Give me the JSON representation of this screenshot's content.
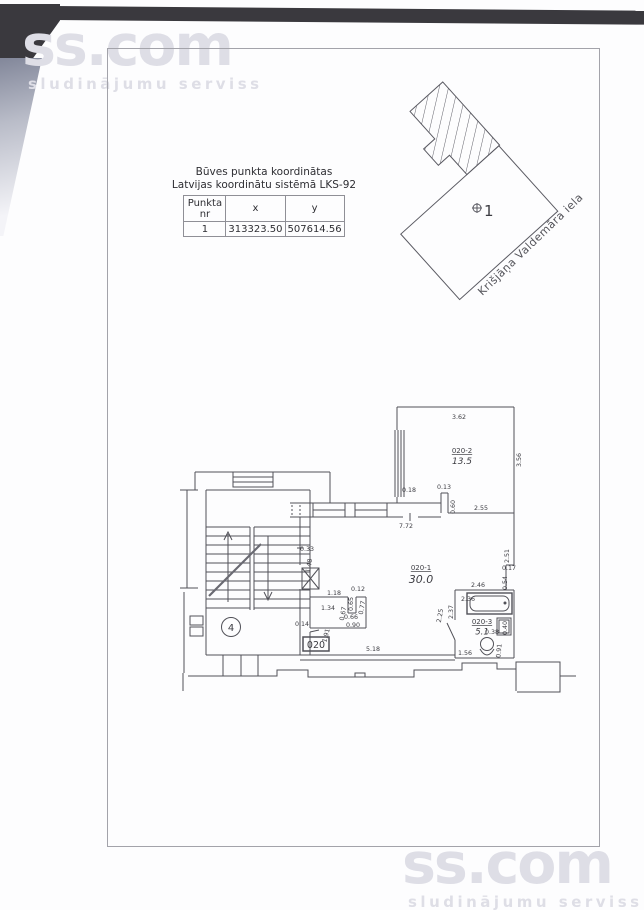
{
  "watermark": {
    "brand": "ss.com",
    "tagline": "sludinājumu serviss"
  },
  "coordinate_table": {
    "title_line1": "Būves punkta koordinātas",
    "title_line2": "Latvijas koordinātu sistēmā LKS-92",
    "headers": {
      "point": "Punkta nr",
      "x": "x",
      "y": "y"
    },
    "rows": [
      {
        "nr": "1",
        "x": "313323.50",
        "y": "507614.56"
      }
    ]
  },
  "site_plan": {
    "street_label": "Krišjāņa Valdemāra iela",
    "point_label": "1"
  },
  "floor_plan": {
    "stair_number": "4",
    "door_plate": "020",
    "room_labels": [
      {
        "id": "020-1",
        "area": "30.0",
        "x": 421,
        "y": 570,
        "size": 11
      },
      {
        "id": "020-2",
        "area": "13.5",
        "x": 462,
        "y": 453,
        "size": 9
      },
      {
        "id": "020-3",
        "area": "5.1",
        "x": 482,
        "y": 624,
        "size": 8.5
      }
    ],
    "dimension_labels": [
      {
        "t": "3.62",
        "x": 459,
        "y": 419
      },
      {
        "t": "3.56",
        "x": 521,
        "y": 460,
        "r": -90
      },
      {
        "t": "0.18",
        "x": 409,
        "y": 492
      },
      {
        "t": "0.13",
        "x": 444,
        "y": 489
      },
      {
        "t": "0.60",
        "x": 455,
        "y": 507,
        "r": -90
      },
      {
        "t": "2.55",
        "x": 481,
        "y": 510
      },
      {
        "t": "7.72",
        "x": 406,
        "y": 528
      },
      {
        "t": "2.51",
        "x": 509,
        "y": 556,
        "r": -90
      },
      {
        "t": "0.33",
        "x": 307,
        "y": 551
      },
      {
        "t": "1.48",
        "x": 311,
        "y": 566,
        "r": -80
      },
      {
        "t": "0.17",
        "x": 509,
        "y": 570
      },
      {
        "t": "0.54",
        "x": 507,
        "y": 583,
        "r": -90
      },
      {
        "t": "2.46",
        "x": 478,
        "y": 587
      },
      {
        "t": "1.18",
        "x": 334,
        "y": 595
      },
      {
        "t": "0.12",
        "x": 358,
        "y": 591
      },
      {
        "t": "2.36",
        "x": 468,
        "y": 601
      },
      {
        "t": "0.65",
        "x": 353,
        "y": 604,
        "r": -90
      },
      {
        "t": "0.77",
        "x": 364,
        "y": 608,
        "r": -80
      },
      {
        "t": "2.37",
        "x": 453,
        "y": 612,
        "r": -90
      },
      {
        "t": "1.34",
        "x": 328,
        "y": 610
      },
      {
        "t": "0.67",
        "x": 345,
        "y": 614,
        "r": -80
      },
      {
        "t": "0.66",
        "x": 351,
        "y": 619
      },
      {
        "t": "2.25",
        "x": 442,
        "y": 616,
        "r": -80
      },
      {
        "t": "0.14",
        "x": 302,
        "y": 626
      },
      {
        "t": "0.90",
        "x": 353,
        "y": 627
      },
      {
        "t": "0.38",
        "x": 492,
        "y": 634
      },
      {
        "t": "0.40",
        "x": 507,
        "y": 628,
        "r": -90
      },
      {
        "t": "1.91",
        "x": 328,
        "y": 636,
        "r": -75
      },
      {
        "t": "0.91",
        "x": 501,
        "y": 651,
        "r": -85
      },
      {
        "t": "1.56",
        "x": 465,
        "y": 655
      },
      {
        "t": "5.18",
        "x": 373,
        "y": 651
      }
    ]
  }
}
